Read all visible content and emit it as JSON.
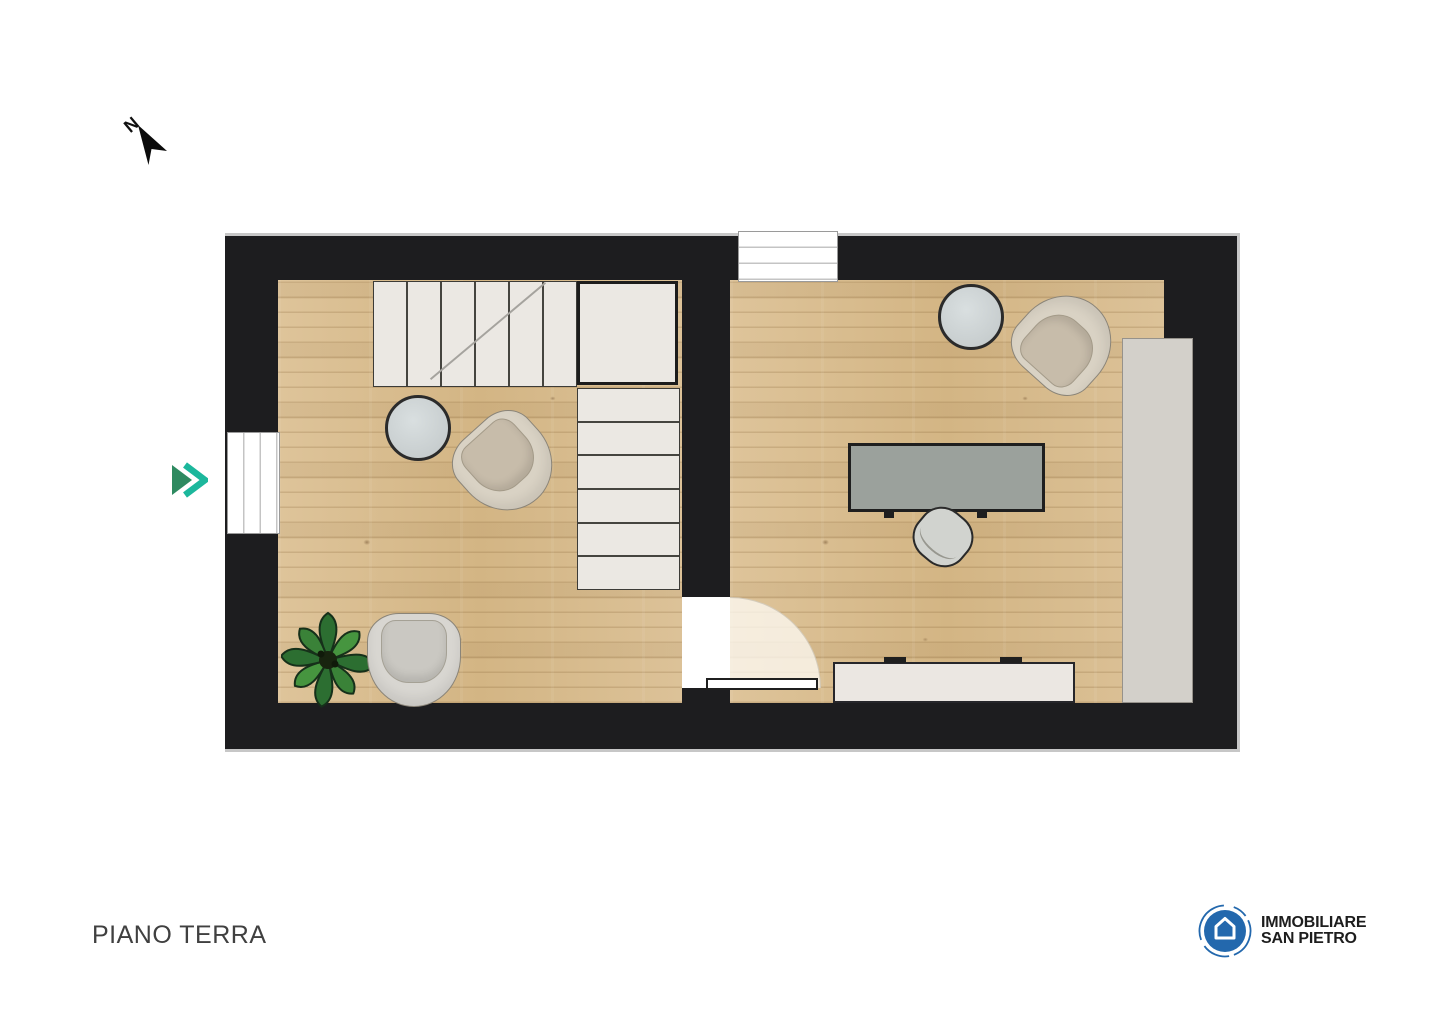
{
  "texts": {
    "title": "PIANO TERRA",
    "compass": "N",
    "brand_line1": "IMMOBILIARE",
    "brand_line2": "SAN PIETRO"
  },
  "palette": {
    "page_bg": "#ffffff",
    "wall": "#1d1d1f",
    "wall_edge": "#c7c7c7",
    "floor_base": "#d8bc90",
    "stair_fill": "#ebe8e3",
    "stair_line": "#45443f",
    "landing_border": "#1c1c1c",
    "window_fill": "#ffffff",
    "window_frame": "#9a9a9a",
    "window_mullion": "#c4c4c4",
    "door_fill": "#ffffff",
    "door_border": "#1f1f1f",
    "arc_fill": "rgba(252,248,241,0.78)",
    "table_fill": "#c7cdce",
    "table_border": "#2b2b2b",
    "armchair_cream": "#d9d2c4",
    "armchair_cream_cushion": "#c7bcaa",
    "armchair_gray": "#d8d6d1",
    "armchair_gray_cushion": "#cac8c2",
    "chair_outline": "#8a8478",
    "desk_fill": "#9ba19c",
    "desk_border": "#1f1f1f",
    "desk_chair_fill": "#d1d3cf",
    "desk_chair_border": "#2a2a2a",
    "cabinet_fill": "#d3d0ca",
    "cabinet_border": "#96928b",
    "sideboard_fill": "#ebe7e2",
    "sideboard_border": "#26262a",
    "plant_leaf_dark": "#2c6e31",
    "plant_leaf_light": "#46953f",
    "plant_center": "#18240f",
    "entrance_solid": "#2e8a60",
    "entrance_outline": "#1cb79c",
    "compass_color": "#0d0d0d",
    "logo_blue": "#2368ad",
    "logo_text": "#1d1d1d",
    "title_color": "#404040"
  }
}
